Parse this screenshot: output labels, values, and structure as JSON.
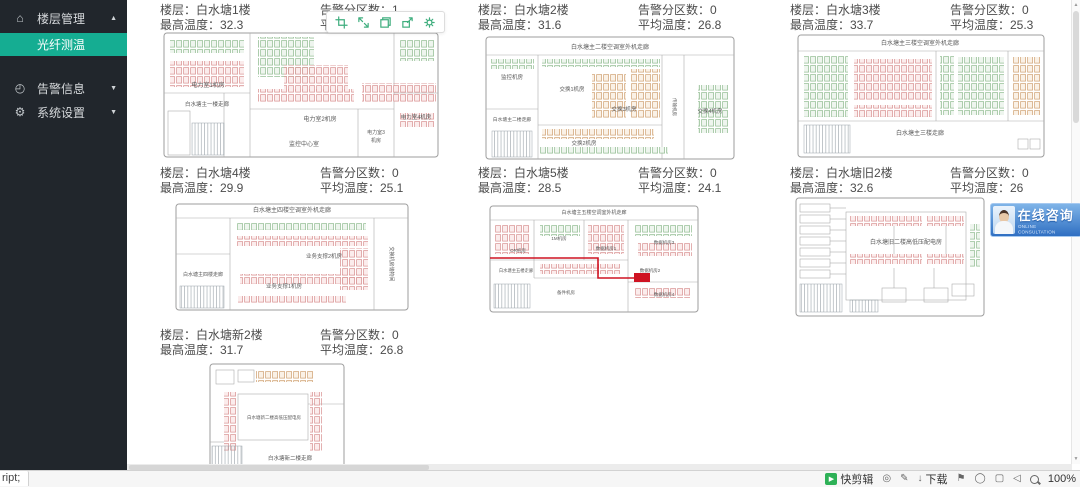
{
  "sidebar": {
    "items": [
      {
        "label": "楼层管理",
        "icon": "home-icon",
        "arrow": "up"
      },
      {
        "label": "光纤测温",
        "active": true
      },
      {
        "label": "告警信息",
        "icon": "alarm-icon",
        "arrow": "down"
      },
      {
        "label": "系统设置",
        "icon": "gear-icon",
        "arrow": "down"
      }
    ]
  },
  "colors": {
    "sidebar_bg": "#21262c",
    "active_teal": "#15ad92",
    "alarm_red": "#cf1322",
    "consult_blue": "#2f6fc2",
    "rack_pink": "#d89090",
    "rack_green": "#8fbb8f",
    "rack_orange": "#cfa070"
  },
  "floors": [
    {
      "floor_line": "楼层：白水塘1楼",
      "max_line": "最高温度：32.3",
      "zones_line": "告警分区数：1",
      "avg_line": "平"
    },
    {
      "floor_line": "楼层：白水塘2楼",
      "max_line": "最高温度：31.6",
      "zones_line": "告警分区数：0",
      "avg_line": "平均温度：26.8"
    },
    {
      "floor_line": "楼层：白水塘3楼",
      "max_line": "最高温度：33.7",
      "zones_line": "告警分区数：0",
      "avg_line": "平均温度：25.3"
    },
    {
      "floor_line": "楼层：白水塘4楼",
      "max_line": "最高温度：29.9",
      "zones_line": "告警分区数：0",
      "avg_line": "平均温度：25.1"
    },
    {
      "floor_line": "楼层：白水塘5楼",
      "max_line": "最高温度：28.5",
      "zones_line": "告警分区数：0",
      "avg_line": "平均温度：24.1"
    },
    {
      "floor_line": "楼层：白水塘旧2楼",
      "max_line": "最高温度：32.6",
      "zones_line": "告警分区数：0",
      "avg_line": "平均温度：26"
    },
    {
      "floor_line": "楼层：白水塘新2楼",
      "max_line": "最高温度：31.7",
      "zones_line": "告警分区数：0",
      "avg_line": "平均温度：26.8"
    }
  ],
  "capture_toolbar": {
    "icons": [
      "crop-icon",
      "expand-icon",
      "window-icon",
      "share-icon",
      "settings-icon"
    ]
  },
  "consult": {
    "title": "在线咨询",
    "subtitle": "ONLINE CONSULTATION"
  },
  "statusbar": {
    "link": "ript;",
    "quick_edit": "快剪辑",
    "download": "下载",
    "zoom": "100%"
  },
  "plans": [
    {
      "w": 278,
      "h": 128,
      "o": [
        2,
        2,
        274,
        124
      ],
      "ln": [
        [
          88,
          2,
          88,
          126
        ],
        [
          232,
          2,
          232,
          126
        ],
        [
          88,
          78,
          232,
          78
        ],
        [
          196,
          78,
          196,
          126
        ],
        [
          2,
          62,
          88,
          62
        ],
        [
          62,
          62,
          62,
          126
        ],
        [
          232,
          62,
          276,
          62
        ]
      ],
      "rm": [
        [
          6,
          80,
          22,
          44
        ]
      ],
      "rk": [
        [
          8,
          8,
          74,
          14,
          "G"
        ],
        [
          8,
          30,
          74,
          26,
          "P"
        ],
        [
          96,
          6,
          56,
          40,
          "G"
        ],
        [
          122,
          34,
          64,
          26,
          "P"
        ],
        [
          96,
          58,
          96,
          14,
          "P"
        ],
        [
          238,
          8,
          34,
          22,
          "G"
        ],
        [
          200,
          52,
          74,
          20,
          "P"
        ],
        [
          238,
          82,
          34,
          14,
          "P"
        ]
      ],
      "ht": [
        [
          30,
          92,
          32,
          32
        ]
      ],
      "lb": [
        {
          "t": "电力室1机房",
          "x": 46,
          "y": 56,
          "s": 6
        },
        {
          "t": "白水塘主一楼走廊",
          "x": 45,
          "y": 75,
          "s": 5.5
        },
        {
          "t": "电力室2机房",
          "x": 158,
          "y": 90,
          "s": 6
        },
        {
          "t": "监控中心室",
          "x": 142,
          "y": 115,
          "s": 6
        },
        {
          "t": "电力室3",
          "x": 214,
          "y": 103,
          "s": 5
        },
        {
          "t": "机房",
          "x": 214,
          "y": 111,
          "s": 5
        },
        {
          "t": "电力室4机房",
          "x": 254,
          "y": 88,
          "s": 5.5
        }
      ]
    },
    {
      "w": 252,
      "h": 132,
      "o": [
        2,
        8,
        248,
        122
      ],
      "ln": [
        [
          2,
          26,
          250,
          26
        ],
        [
          54,
          26,
          54,
          130
        ],
        [
          2,
          80,
          54,
          80
        ],
        [
          178,
          26,
          178,
          130
        ],
        [
          200,
          26,
          200,
          130
        ],
        [
          54,
          96,
          178,
          96
        ]
      ],
      "rk": [
        [
          58,
          30,
          118,
          8,
          "G"
        ],
        [
          146,
          40,
          30,
          50,
          "O"
        ],
        [
          108,
          44,
          34,
          46,
          "O"
        ],
        [
          58,
          100,
          112,
          10,
          "O"
        ],
        [
          56,
          118,
          128,
          8,
          "G"
        ],
        [
          214,
          56,
          30,
          48,
          "G"
        ],
        [
          6,
          30,
          44,
          10,
          "G"
        ]
      ],
      "ht": [
        [
          8,
          102,
          40,
          26
        ]
      ],
      "lb": [
        {
          "t": "白水塘主二楼空调室外机走廊",
          "x": 126,
          "y": 20,
          "s": 6
        },
        {
          "t": "监控机房",
          "x": 28,
          "y": 50,
          "s": 5.5
        },
        {
          "t": "交换1机房",
          "x": 88,
          "y": 62,
          "s": 5.5
        },
        {
          "t": "白水塘主二楼走廊",
          "x": 28,
          "y": 92,
          "s": 4.8
        },
        {
          "t": "交换3机房",
          "x": 140,
          "y": 82,
          "s": 5.5
        },
        {
          "t": "传输机房",
          "x": 189,
          "y": 78,
          "s": 4.5,
          "r": 90
        },
        {
          "t": "交换4机房",
          "x": 226,
          "y": 84,
          "s": 5.5
        },
        {
          "t": "交换2机房",
          "x": 100,
          "y": 116,
          "s": 5.5
        }
      ]
    },
    {
      "w": 250,
      "h": 130,
      "o": [
        2,
        6,
        246,
        122
      ],
      "ln": [
        [
          2,
          22,
          248,
          22
        ],
        [
          2,
          92,
          248,
          92
        ],
        [
          140,
          22,
          140,
          92
        ],
        [
          212,
          22,
          212,
          92
        ]
      ],
      "rm": [
        [
          222,
          110,
          10,
          10
        ],
        [
          234,
          110,
          10,
          10
        ]
      ],
      "rk": [
        [
          8,
          26,
          44,
          62,
          "G"
        ],
        [
          58,
          30,
          78,
          42,
          "P"
        ],
        [
          144,
          26,
          14,
          60,
          "G"
        ],
        [
          162,
          28,
          46,
          58,
          "G"
        ],
        [
          216,
          28,
          28,
          58,
          "O"
        ],
        [
          58,
          76,
          78,
          12,
          "P"
        ]
      ],
      "ht": [
        [
          8,
          96,
          46,
          28
        ]
      ],
      "lb": [
        {
          "t": "白水塘主三楼空调室外机走廊",
          "x": 124,
          "y": 16,
          "s": 6
        },
        {
          "t": "白水塘主三楼走廊",
          "x": 124,
          "y": 106,
          "s": 6
        }
      ]
    },
    {
      "w": 236,
      "h": 118,
      "o": [
        2,
        8,
        232,
        106
      ],
      "ln": [
        [
          2,
          22,
          234,
          22
        ],
        [
          56,
          22,
          56,
          114
        ],
        [
          2,
          58,
          56,
          58
        ],
        [
          200,
          22,
          200,
          114
        ]
      ],
      "rk": [
        [
          62,
          26,
          130,
          8,
          "G"
        ],
        [
          62,
          40,
          132,
          10,
          "P"
        ],
        [
          66,
          78,
          124,
          10,
          "P"
        ],
        [
          64,
          100,
          108,
          8,
          "P"
        ],
        [
          166,
          52,
          28,
          42,
          "P"
        ]
      ],
      "ht": [
        [
          6,
          90,
          44,
          22
        ]
      ],
      "lb": [
        {
          "t": "白水塘主四楼空调室外机走廊",
          "x": 118,
          "y": 16,
          "s": 6
        },
        {
          "t": "白水塘主四楼走廊",
          "x": 29,
          "y": 80,
          "s": 5
        },
        {
          "t": "业务支撑1机房",
          "x": 110,
          "y": 92,
          "s": 5.5
        },
        {
          "t": "业务支撑2机房",
          "x": 150,
          "y": 62,
          "s": 5.5
        },
        {
          "t": "交换机房储物间",
          "x": 216,
          "y": 68,
          "s": 5,
          "r": 90
        }
      ]
    },
    {
      "w": 212,
      "h": 118,
      "o": [
        2,
        8,
        208,
        106
      ],
      "ln": [
        [
          2,
          22,
          210,
          22
        ],
        [
          46,
          22,
          46,
          80
        ],
        [
          96,
          22,
          96,
          62
        ],
        [
          2,
          62,
          140,
          62
        ],
        [
          140,
          22,
          140,
          114
        ],
        [
          140,
          84,
          210,
          84
        ],
        [
          46,
          80,
          140,
          80
        ]
      ],
      "rk": [
        [
          6,
          26,
          36,
          30,
          "P"
        ],
        [
          52,
          26,
          40,
          12,
          "G"
        ],
        [
          100,
          26,
          36,
          30,
          "P"
        ],
        [
          146,
          26,
          58,
          12,
          "G"
        ],
        [
          150,
          44,
          54,
          14,
          "P"
        ],
        [
          52,
          66,
          80,
          10,
          "P"
        ],
        [
          146,
          90,
          56,
          10,
          "P"
        ]
      ],
      "ht": [
        [
          6,
          86,
          36,
          24
        ]
      ],
      "red": {
        "p": "M2 60 L110 60 L110 80 L146 80",
        "r": [
          146,
          75,
          16,
          9
        ]
      },
      "lb": [
        {
          "t": "白水塘主五楼空调室外机走廊",
          "x": 106,
          "y": 16,
          "s": 5
        },
        {
          "t": "OR机房",
          "x": 30,
          "y": 54,
          "s": 4.5
        },
        {
          "t": "1M机房",
          "x": 71,
          "y": 42,
          "s": 4.5
        },
        {
          "t": "数据机房1",
          "x": 118,
          "y": 52,
          "s": 4.5
        },
        {
          "t": "数据机房3",
          "x": 176,
          "y": 46,
          "s": 4.5
        },
        {
          "t": "白水塘主五楼走廊",
          "x": 28,
          "y": 74,
          "s": 4.3
        },
        {
          "t": "数据机房2",
          "x": 162,
          "y": 74,
          "s": 4.5
        },
        {
          "t": "备件机房",
          "x": 78,
          "y": 96,
          "s": 4.5
        },
        {
          "t": "数据机房4",
          "x": 176,
          "y": 98,
          "s": 4.5
        }
      ]
    },
    {
      "w": 192,
      "h": 122,
      "o": [
        2,
        2,
        188,
        118
      ],
      "rm": [
        [
          52,
          16,
          120,
          88
        ],
        [
          6,
          8,
          30,
          8
        ],
        [
          6,
          19,
          30,
          8
        ],
        [
          6,
          30,
          30,
          8
        ],
        [
          6,
          41,
          30,
          8
        ],
        [
          6,
          52,
          30,
          8
        ],
        [
          6,
          63,
          30,
          8
        ],
        [
          6,
          74,
          30,
          8
        ],
        [
          88,
          92,
          24,
          14
        ],
        [
          130,
          92,
          24,
          14
        ],
        [
          158,
          88,
          22,
          12
        ]
      ],
      "ln": [
        [
          36,
          12,
          52,
          12
        ],
        [
          36,
          23,
          52,
          23
        ],
        [
          36,
          34,
          52,
          34
        ],
        [
          36,
          45,
          52,
          45
        ],
        [
          36,
          56,
          52,
          56
        ],
        [
          36,
          67,
          52,
          67
        ],
        [
          36,
          78,
          52,
          78
        ],
        [
          100,
          30,
          100,
          58
        ],
        [
          152,
          30,
          152,
          58
        ],
        [
          100,
          72,
          100,
          92
        ],
        [
          140,
          72,
          140,
          92
        ]
      ],
      "rk": [
        [
          56,
          20,
          72,
          10,
          "P"
        ],
        [
          132,
          20,
          38,
          10,
          "P"
        ],
        [
          56,
          58,
          72,
          10,
          "P"
        ],
        [
          132,
          58,
          38,
          10,
          "P"
        ],
        [
          176,
          28,
          10,
          44,
          "G"
        ]
      ],
      "ht": [
        [
          6,
          88,
          42,
          28
        ],
        [
          56,
          104,
          28,
          12
        ]
      ],
      "lb": [
        {
          "t": "白水塘旧二楼高低压配电房",
          "x": 112,
          "y": 48,
          "s": 6
        }
      ]
    },
    {
      "w": 300,
      "h": 116,
      "o": [
        50,
        2,
        134,
        106
      ],
      "rm": [
        [
          78,
          32,
          70,
          46
        ],
        [
          56,
          8,
          18,
          14
        ],
        [
          78,
          8,
          16,
          12
        ]
      ],
      "ln": [
        [
          50,
          80,
          64,
          80
        ],
        [
          148,
          42,
          184,
          42
        ]
      ],
      "rk": [
        [
          96,
          8,
          58,
          12,
          "O"
        ],
        [
          64,
          30,
          12,
          60,
          "P"
        ],
        [
          150,
          30,
          12,
          60,
          "P"
        ]
      ],
      "ht": [
        [
          52,
          84,
          30,
          20
        ]
      ],
      "lb": [
        {
          "t": "白水塘新二楼高低压配电房",
          "x": 114,
          "y": 57,
          "s": 4.5
        },
        {
          "t": "白水塘新二楼走廊",
          "x": 130,
          "y": 98,
          "s": 5.5
        }
      ]
    }
  ]
}
